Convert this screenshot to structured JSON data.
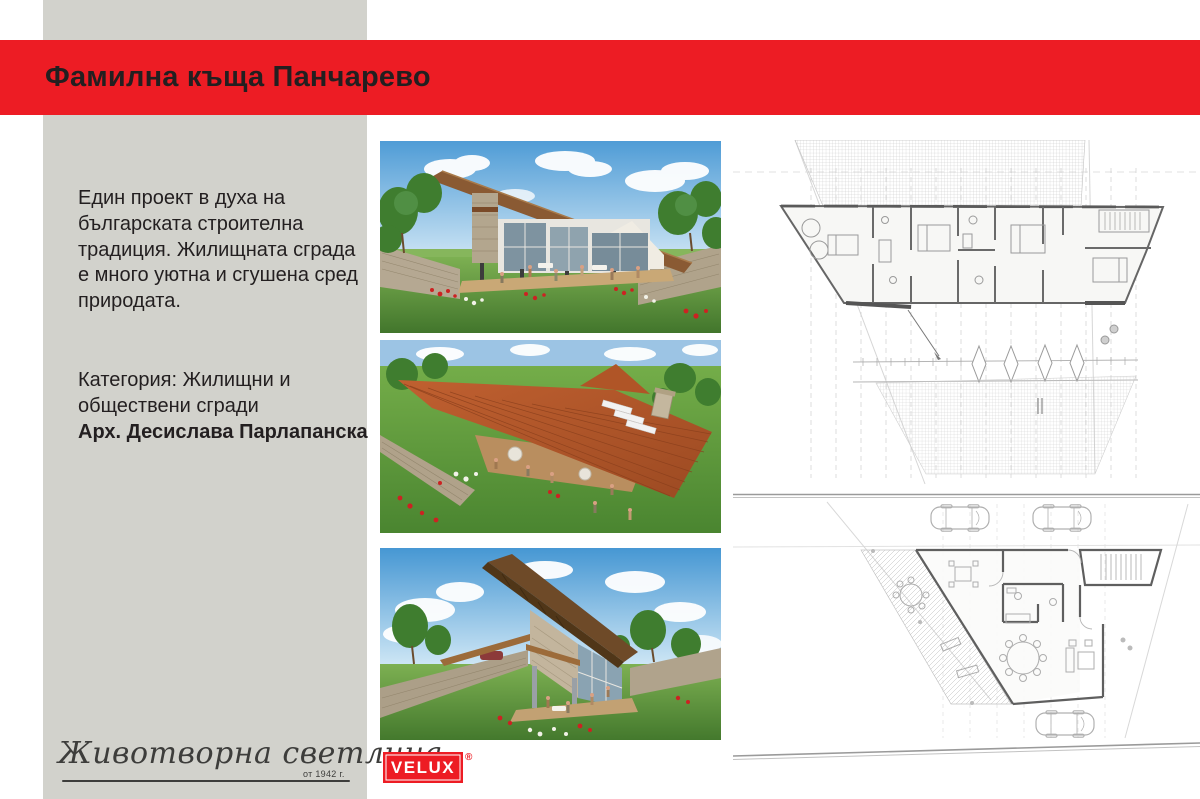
{
  "colors": {
    "accent_red": "#ed1c24",
    "panel_gray": "#d2d2cc",
    "ink": "#231f20",
    "signature_gray": "#3d3d3b"
  },
  "header": {
    "title": "Фамилна къща Панчарево"
  },
  "info_panel": {
    "description_lines": [
      "Един проект в духа на",
      "българската строителна",
      "традиция. Жилищната сграда",
      "е много уютна и сгушена сред",
      "природата."
    ],
    "category_lines": [
      "Категория: Жилищни и",
      "обществени сгради"
    ],
    "architect": "Арх. Десислава Парлапанска"
  },
  "footer": {
    "signature_script": "Животворна светлина",
    "signature_since": "от 1942 г.",
    "brand_logo_text": "VELUX",
    "registered_mark": "®"
  }
}
